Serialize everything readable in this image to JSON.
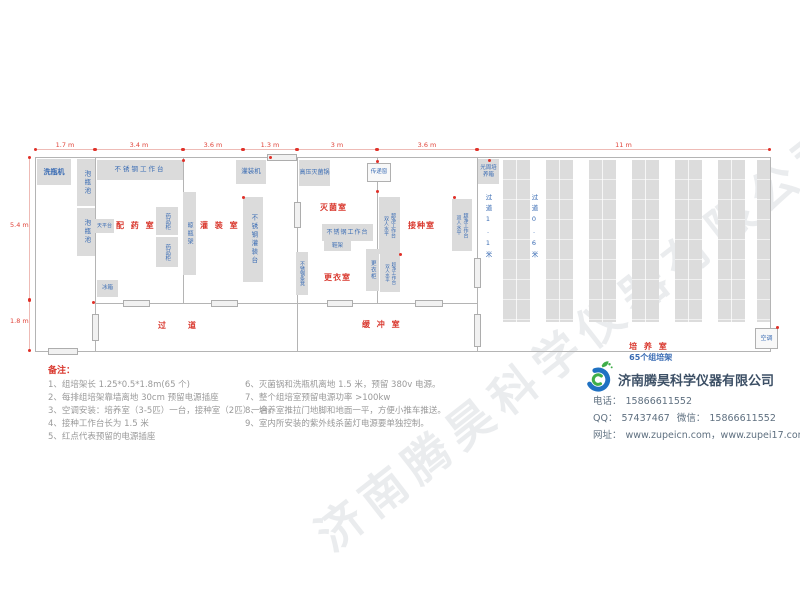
{
  "plan": {
    "dims": {
      "top1": "1.7 m",
      "top2": "3.4 m",
      "top3": "3.6 m",
      "top4": "1.3 m",
      "top5": "3 m",
      "top6": "3.6 m",
      "top7": "11 m",
      "left1": "5.4 m",
      "left2": "1.8 m"
    },
    "rooms": {
      "prep": "配 药 室",
      "filling": "灌 装 室",
      "corridor": "过　　道",
      "sterilize": "灭菌室",
      "dressing": "更衣室",
      "inoculation": "接种室",
      "buffer": "缓 冲 室",
      "culture": "培 养 室",
      "culture_sub": "65个组培架",
      "aisle1": "过道1.1米",
      "aisle2": "过道0.6米"
    },
    "equipment": {
      "bottle_washer": "洗瓶机",
      "soak_pool": "泡瓶池",
      "steel_worktable": "不锈钢工作台",
      "balance_table": "天平台",
      "medicine_cabinet": "药品柜",
      "bottle_dry_rack": "晾瓶架",
      "fridge": "冰箱",
      "filling_machine": "灌装机",
      "steel_filling_table": "不锈钢灌装台",
      "autoclave": "高压灭菌锅",
      "transfer_window": "传递窗",
      "shoe_rack": "鞋架",
      "steel_bench": "不锈钢条凳",
      "locker": "更衣柜",
      "clean_bench_line1": "双人水平",
      "clean_bench_line2": "超净工作台",
      "photoperiod_incubator": "光周培养箱",
      "air_conditioner": "空调"
    }
  },
  "notes": {
    "title": "备注：",
    "left": [
      "1、组培架长 1.25*0.5*1.8m(65 个)",
      "2、每排组培架靠墙离地 30cm 预留电源插座",
      "3、空调安装：培养室（3-5匹）一台，接种室（2匹）一台。",
      "4、接种工作台长为 1.5 米",
      "5、红点代表预留的电源插座"
    ],
    "right": [
      "6、灭菌锅和洗瓶机离地 1.5 米，预留 380v 电源。",
      "7、整个组培室预留电源功率 >100kw",
      "8、培养室推拉门地脚和地面一平，方便小推车推送。",
      "9、室内所安装的紫外线杀菌灯电源要单独控制。"
    ]
  },
  "company": {
    "name": "济南腾昊科学仪器有限公司",
    "phone_label": "电话：",
    "phone": "15866611552",
    "qq_label": "QQ：",
    "qq": "57437467",
    "wechat_label": "微信：",
    "wechat": "15866611552",
    "web_label": "网址：",
    "web": "www.zupeicn.com，www.zupei17.com"
  },
  "watermark": "济南腾昊科学仪器有限公司",
  "colors": {
    "room_label": "#d9382e",
    "equipment_label": "#3a6cb4",
    "dimension": "#e0443a",
    "wall": "#b4b4b4",
    "furniture_fill": "#dbdbdb",
    "note_text": "#9a9a9a",
    "company_name": "#3d5066",
    "logo_blue": "#1f71c2",
    "logo_green": "#3fae49"
  }
}
